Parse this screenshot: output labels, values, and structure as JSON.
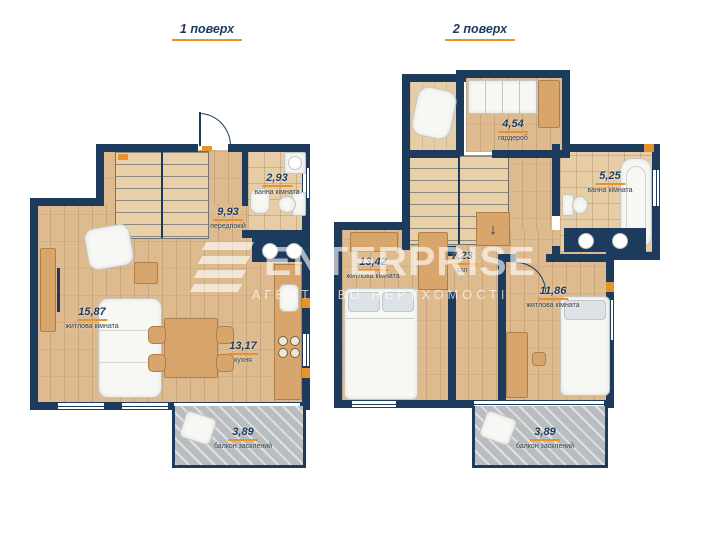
{
  "floors": [
    {
      "title": "1 поверх",
      "rooms": [
        {
          "area": "15,87",
          "name": "житлова кімната"
        },
        {
          "area": "13,17",
          "name": "кухня"
        },
        {
          "area": "9,93",
          "name": "передпокій"
        },
        {
          "area": "2,93",
          "name": "ванна кімната"
        },
        {
          "area": "3,89",
          "name": "балкон засклений"
        }
      ]
    },
    {
      "title": "2 поверх",
      "rooms": [
        {
          "area": "13,42",
          "name": "житлова кімната"
        },
        {
          "area": "11,86",
          "name": "житлова кімната"
        },
        {
          "area": "7,23",
          "name": "хол"
        },
        {
          "area": "5,25",
          "name": "ванна кімната"
        },
        {
          "area": "4,54",
          "name": "гардероб"
        },
        {
          "area": "3,89",
          "name": "балкон засклений"
        }
      ]
    }
  ],
  "watermark": {
    "brand": "ENTERPRISE",
    "subtitle": "АГЕНТСТВО НЕРУХОМОСТІ"
  },
  "icons": {
    "stairs_down_arrow": "↓"
  },
  "colors": {
    "wall_navy": "#1d3c5d",
    "accent_orange": "#e8922d",
    "balcony_gray": "#b9bdbf",
    "wood": "#debb8f"
  }
}
